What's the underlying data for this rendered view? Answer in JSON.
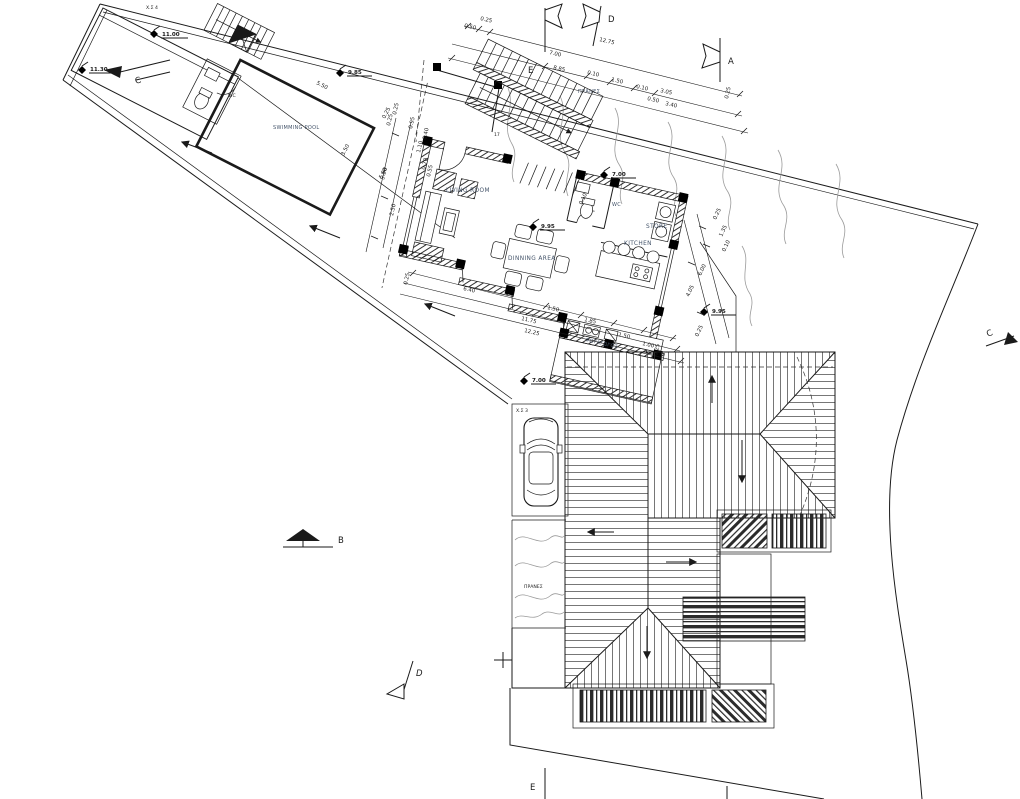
{
  "drawing": {
    "rooms": {
      "living_room": "LIVING ROOM",
      "dining_area": "DINNING AREA",
      "kitchen": "KITCHEN",
      "store": "STORE",
      "wc": "WC",
      "wc_pool": "WC",
      "swimming_pool": "SWIMMING POOL"
    },
    "site": {
      "pranes_top": "ΠΡΑΝΕΣ",
      "pranes_side": "ΠΡΑΝΕΣ",
      "light_well": "ΦΩΤΑΓΩΓΟΣ",
      "parking_4": "Χ.Σ 4",
      "parking_3": "Χ.Σ 3",
      "stair_count": "17"
    },
    "elevations": {
      "garage": "11.00",
      "upper": "11.30",
      "pool_deck": "9.85",
      "floor": "9.95",
      "court": "9.95",
      "stairs_mid": "7.00",
      "carport": "7.00"
    },
    "sections": {
      "a": "A",
      "b": "B",
      "c_left": "C",
      "c_right": "C",
      "d_top": "D",
      "d_bottom": "D",
      "e_top": "E",
      "e_bottom": "E"
    },
    "dimensions": {
      "top": [
        "0.25",
        "0.50",
        "7.00",
        "12.75",
        "8.85",
        "0.10",
        "1.50",
        "0.10",
        "0.50",
        "3.05",
        "3.40",
        "0.25"
      ],
      "bottom": [
        "0.25",
        "6.40",
        "11.75",
        "12.25",
        "1.50",
        "1.85",
        "1.50",
        "1.00",
        "0.25"
      ],
      "right": [
        "0.25",
        "1.35",
        "0.10",
        "6.00",
        "4.05",
        "0.25"
      ],
      "left": [
        "0.25",
        "5.50",
        "2.50",
        "0.95",
        "0.40",
        "1.10",
        "0.70",
        "0.55"
      ],
      "pool": [
        "5.50",
        "3.50",
        "0.25",
        "5.50"
      ],
      "misc": [
        "0.10",
        "0.25"
      ]
    }
  }
}
